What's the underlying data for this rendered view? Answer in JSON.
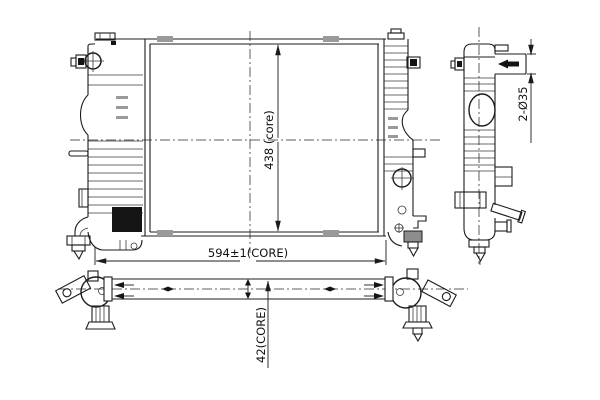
{
  "dimensions": {
    "core_height": "438 (core)",
    "core_width": "594±1(CORE)",
    "pipe_diameter": "2-Ø35",
    "core_depth": "42(CORE)"
  },
  "colors": {
    "line": "#1c1c1c",
    "clip_gray": "#9a9a9a",
    "background": "#ffffff"
  }
}
